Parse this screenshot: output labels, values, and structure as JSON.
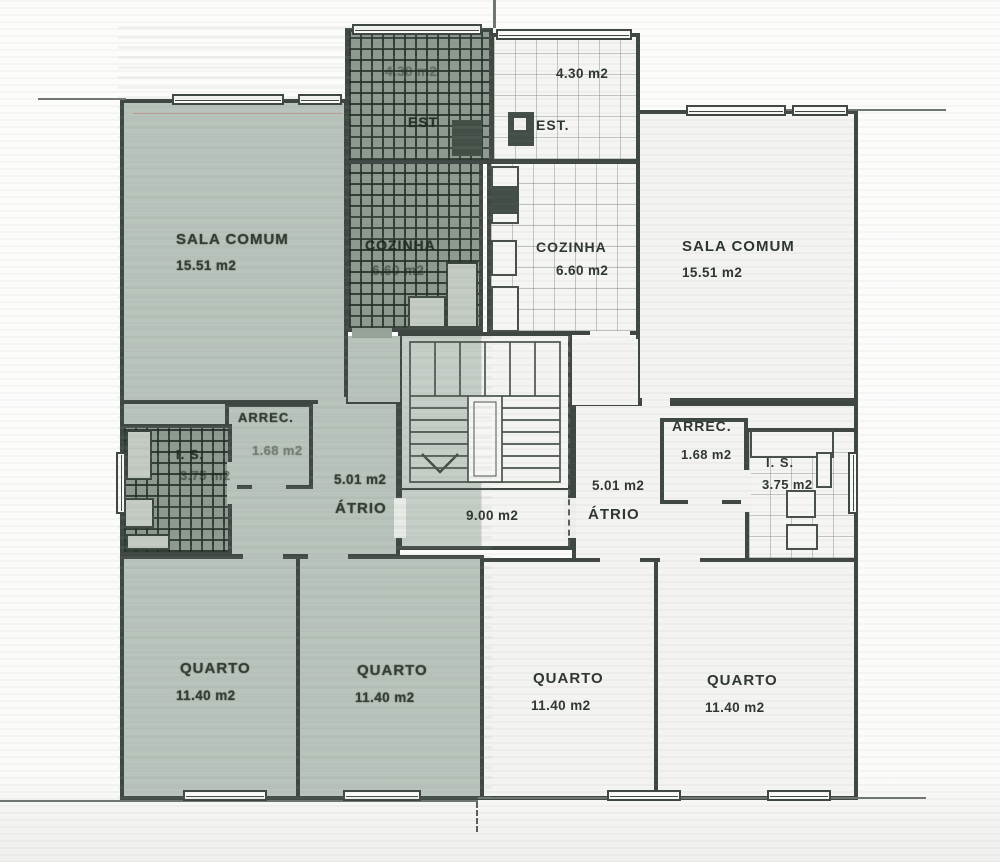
{
  "plan": {
    "stairwell": {
      "area": "9.00 m2"
    },
    "left_unit": {
      "sala_comum": {
        "name": "SALA COMUM",
        "area": "15.51 m2"
      },
      "est": {
        "name": "EST",
        "area": "4.30 m2"
      },
      "cozinha": {
        "name": "COZINHA",
        "area": "6.60 m2"
      },
      "arrec": {
        "name": "ARREC.",
        "area": "1.68 m2"
      },
      "is": {
        "name": "I. S.",
        "area": "3.75 m2"
      },
      "atrio": {
        "name": "ÁTRIO",
        "area": "5.01 m2"
      },
      "quarto_1": {
        "name": "QUARTO",
        "area": "11.40 m2"
      },
      "quarto_2": {
        "name": "QUARTO",
        "area": "11.40 m2"
      }
    },
    "right_unit": {
      "est": {
        "name": "EST.",
        "area": "4.30 m2"
      },
      "cozinha": {
        "name": "COZINHA",
        "area": "6.60 m2"
      },
      "sala_comum": {
        "name": "SALA COMUM",
        "area": "15.51 m2"
      },
      "arrec": {
        "name": "ARREC.",
        "area": "1.68 m2"
      },
      "is": {
        "name": "I. S.",
        "area": "3.75 m2"
      },
      "atrio": {
        "name": "ÁTRIO",
        "area": "5.01 m2"
      },
      "quarto_1": {
        "name": "QUARTO",
        "area": "11.40 m2"
      },
      "quarto_2": {
        "name": "QUARTO",
        "area": "11.40 m2"
      }
    },
    "colors": {
      "left_unit_fill": "#b9c4bc",
      "right_unit_fill": "#f3f3f0",
      "wall": "#3e4741",
      "hatch_fill": "#8e9a90"
    }
  }
}
